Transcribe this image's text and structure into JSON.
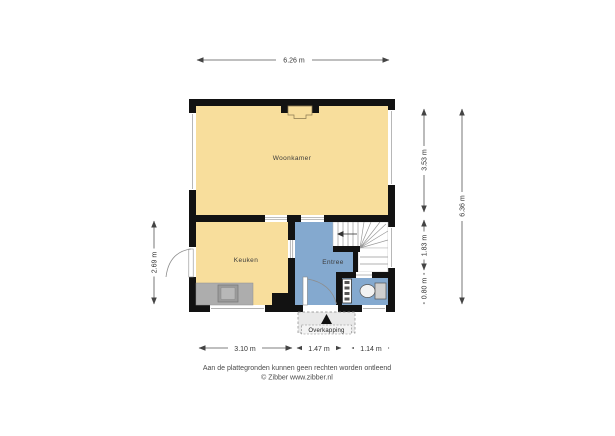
{
  "plan": {
    "rooms": {
      "woonkamer": "Woonkamer",
      "keuken": "Keuken",
      "entree": "Entree",
      "overkapping": "Overkapping"
    },
    "dims": {
      "top_width": "6.26 m",
      "right_upper": "3.53 m",
      "right_middle": "1.83 m",
      "right_lower": "0.80 m",
      "right_total": "6.36 m",
      "left_kitchen": "2.69 m",
      "bottom_left": "3.10 m",
      "bottom_middle": "1.47 m",
      "bottom_right": "1.14 m"
    },
    "colors": {
      "room_fill": "#F8DE9C",
      "hall_fill": "#84A9CF",
      "wall": "#121212",
      "counter": "#ADADAD",
      "canopy_fill": "#E9E9E9"
    }
  },
  "footer": {
    "disclaimer": "Aan de plattegronden kunnen geen rechten worden ontleend",
    "credit": "© Zibber www.zibber.nl"
  }
}
